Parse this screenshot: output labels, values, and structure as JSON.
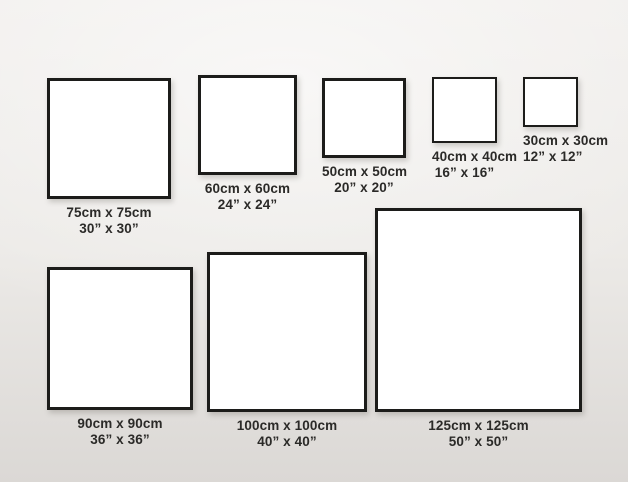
{
  "page": {
    "title": "Square canvas size comparison chart"
  },
  "colors": {
    "bg_top": "#f2f0ee",
    "bg_mid": "#eceae7",
    "bg_bottom": "#dbd8d5",
    "frame_border": "#1c1c1a",
    "frame_fill": "#ffffff",
    "label_text": "#2b2a28"
  },
  "sizes": [
    {
      "id": "75cm",
      "cm": "75cm x 75cm",
      "inches": "30” x 30”"
    },
    {
      "id": "60cm",
      "cm": "60cm x 60cm",
      "inches": "24” x 24”"
    },
    {
      "id": "50cm",
      "cm": "50cm x 50cm",
      "inches": "20” x 20”"
    },
    {
      "id": "40cm",
      "cm": "40cm x 40cm",
      "inches": "16” x 16”"
    },
    {
      "id": "30cm",
      "cm": "30cm x 30cm",
      "inches": "12” x 12”"
    },
    {
      "id": "90cm",
      "cm": "90cm x 90cm",
      "inches": "36” x 36”"
    },
    {
      "id": "100cm",
      "cm": "100cm x 100cm",
      "inches": "40” x 40”"
    },
    {
      "id": "125cm",
      "cm": "125cm x 125cm",
      "inches": "50” x 50”"
    }
  ]
}
